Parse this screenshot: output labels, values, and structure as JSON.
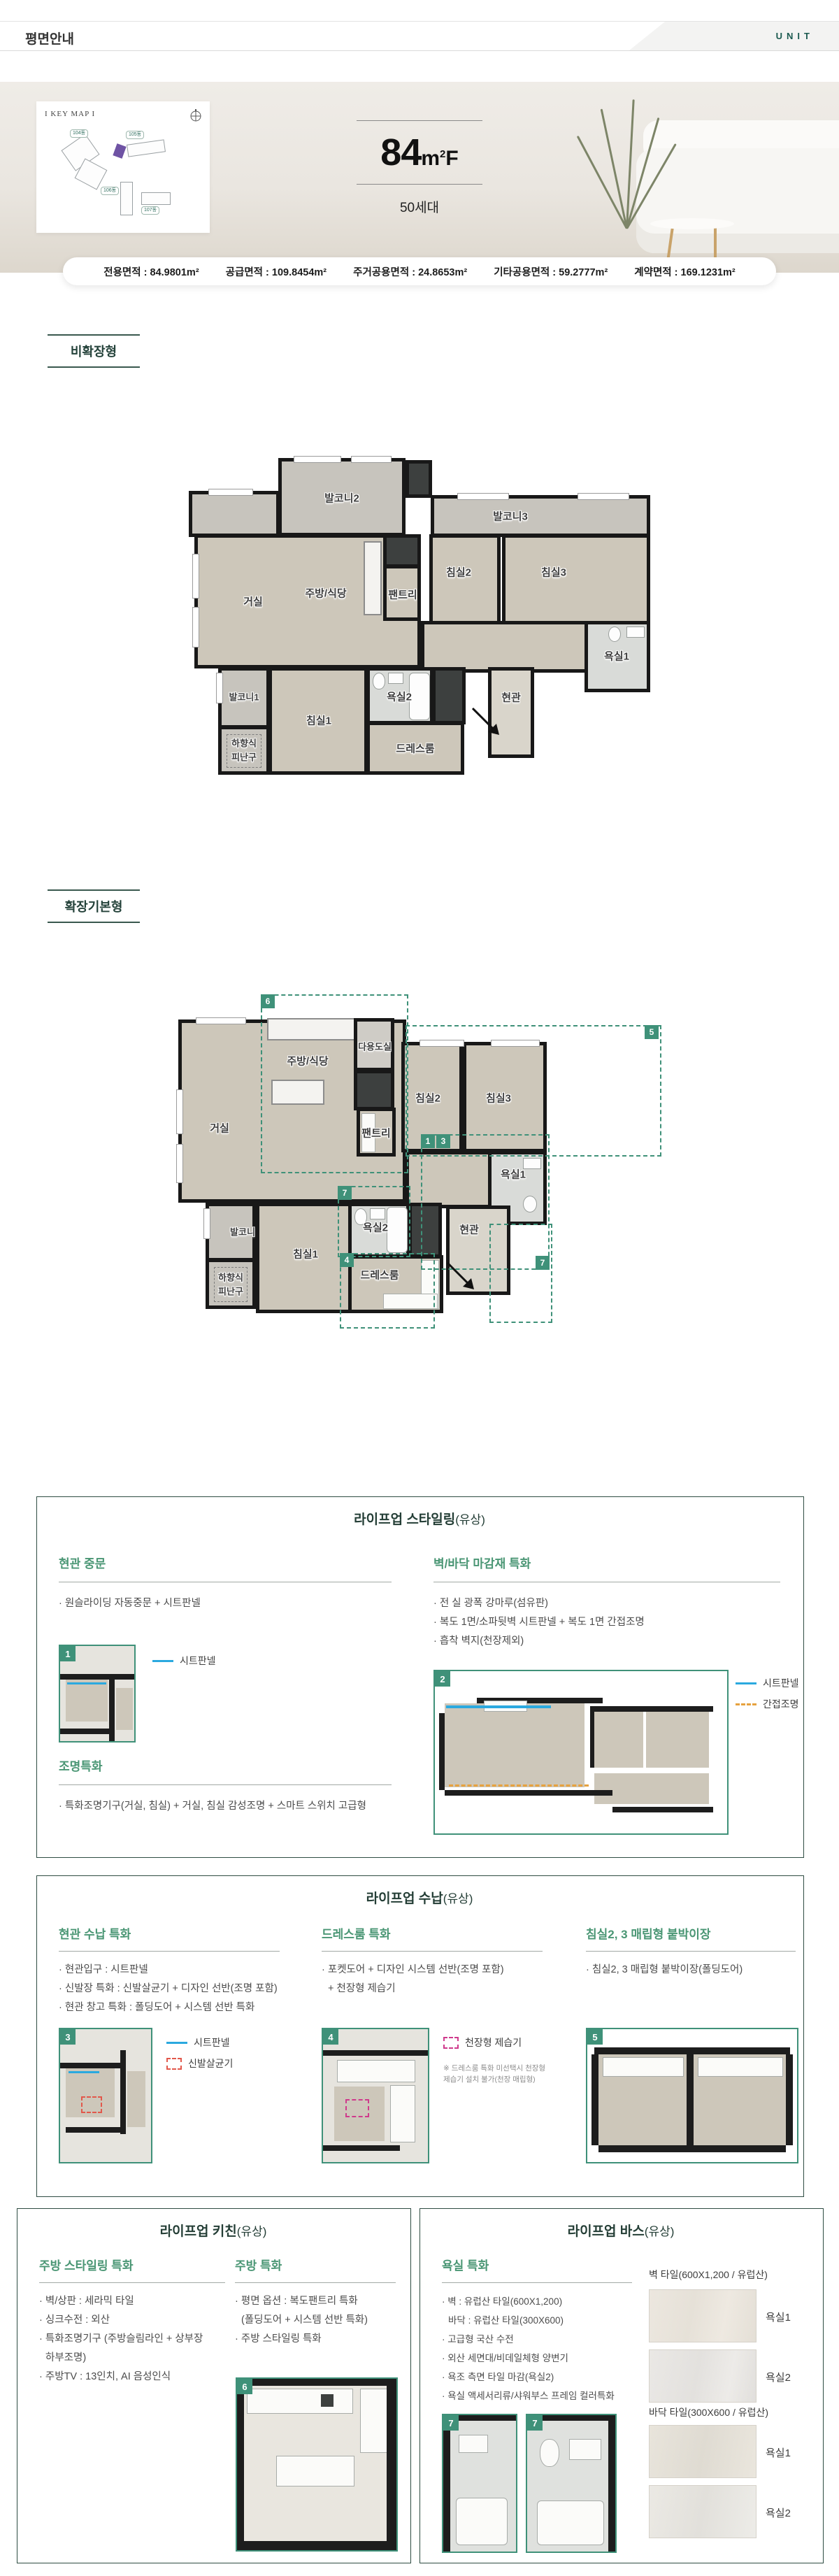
{
  "header": {
    "title": "평면안내",
    "brand": "UNIT"
  },
  "hero": {
    "keymap_label": "I KEY MAP I",
    "buildings": [
      "104동",
      "105동",
      "106동",
      "107동"
    ],
    "unit": {
      "number": "84",
      "suffix": "m",
      "sup": "2",
      "type": "F"
    },
    "households": "50세대"
  },
  "area_bar": {
    "colon": " : ",
    "items": [
      {
        "label": "전용면적",
        "value": "84.9801m²"
      },
      {
        "label": "공급면적",
        "value": "109.8454m²"
      },
      {
        "label": "주거공용면적",
        "value": "24.8653m²"
      },
      {
        "label": "기타공용면적",
        "value": "59.2777m²"
      },
      {
        "label": "계약면적",
        "value": "169.1231m²"
      }
    ]
  },
  "sections": {
    "plan1_label": "비확장형",
    "plan2_label": "확장기본형"
  },
  "plan1": {
    "rooms": {
      "balcony2": "발코니2",
      "balcony3": "발코니3",
      "living": "거실",
      "kitchen": "주방/식당",
      "pantry": "팬트리",
      "bed2": "침실2",
      "bed3": "침실3",
      "bath1": "욕실1",
      "balcony1": "발코니1",
      "escape_a": "하향식",
      "escape_b": "피난구",
      "bed1": "침실1",
      "bath2": "욕실2",
      "dress": "드레스룸",
      "entry": "현관"
    }
  },
  "plan2": {
    "rooms": {
      "kitchen": "주방/식당",
      "utility": "다용도실",
      "living": "거실",
      "pantry": "팬트리",
      "bed2": "침실2",
      "bed3": "침실3",
      "bath1": "욕실1",
      "entry": "현관",
      "balcony": "발코니",
      "escape_a": "하향식",
      "escape_b": "피난구",
      "bed1": "침실1",
      "bath2": "욕실2",
      "dress": "드레스룸"
    },
    "markers": {
      "m6": "6",
      "m5": "5",
      "m1": "1",
      "m3": "3",
      "m7": "7",
      "m4": "4",
      "m7b": "7"
    }
  },
  "legend": {
    "sheet": "시트판넬",
    "indirect": "간접조명",
    "sterilizer": "신발살균기",
    "dehumidifier": "천장형 제습기"
  },
  "styling_box": {
    "title": "라이프업 스타일링",
    "title_sub": "(유상)",
    "door_heading": "현관 중문",
    "door_b0": "· 원슬라이딩 자동중문 + 시트판넬",
    "door_thumb": "1",
    "finish_heading": "벽/바닥 마감재 특화",
    "finish_b0": "· 전 실 광폭 강마루(섬유판)",
    "finish_b1": "· 복도 1면/소파뒷벽 시트판넬 + 복도 1면 간접조명",
    "finish_b2": "· 흡착 벽지(천장제외)",
    "finish_thumb": "2",
    "light_heading": "조명특화",
    "light_b0": "· 특화조명기구(거실, 침실) + 거실, 침실 감성조명 + 스마트 스위치 고급형"
  },
  "storage_box": {
    "title": "라이프업 수납",
    "title_sub": "(유상)",
    "c1_heading": "현관 수납 특화",
    "c1_b0": "· 현관입구 : 시트판넬",
    "c1_b1": "· 신발장 특화 : 신발살균기 + 디자인 선반(조명 포함)",
    "c1_b2": "· 현관 창고 특화 : 폴딩도어 + 시스템 선반 특화",
    "c1_thumb": "3",
    "c2_heading": "드레스룸 특화",
    "c2_b0": "· 포켓도어 + 디자인 시스템 선반(조명 포함)",
    "c2_b1": "+ 천장형 제습기",
    "c2_thumb": "4",
    "c2_note0": "※ 드레스룸 특화 미선택시 천장형",
    "c2_note1": "제습기 설치 불가(천장 매립형)",
    "c3_heading": "침실2, 3 매립형 붙박이장",
    "c3_b0": "· 침실2, 3 매립형 붙박이장(폴딩도어)",
    "c3_thumb": "5"
  },
  "kitchen_box": {
    "title": "라이프업 키친",
    "title_sub": "(유상)",
    "c1_heading": "주방 스타일링 특화",
    "c1_b0": "· 벽/상판 : 세라믹 타일",
    "c1_b1": "· 싱크수전 : 외산",
    "c1_b2": "· 특화조명기구 (주방슬림라인 + 상부장",
    "c1_b3": "하부조명)",
    "c1_b4": "· 주방TV : 13인치, AI 음성인식",
    "c2_heading": "주방 특화",
    "c2_b0": "· 평면 옵션 : 복도팬트리 특화",
    "c2_b1": "(폴딩도어 + 시스템 선반 특화)",
    "c2_b2": "· 주방 스타일링 특화",
    "thumb": "6"
  },
  "bath_box": {
    "title": "라이프업 바스",
    "title_sub": "(유상)",
    "heading": "욕실 특화",
    "b0": "· 벽 : 유럽산 타일(600X1,200)",
    "b1": "바닥 : 유럽산 타일(300X600)",
    "b2": "· 고급형 국산 수전",
    "b3": "· 외산 세면대/비데일체형 양변기",
    "b4": "· 욕조 측면 타일 마감(욕실2)",
    "b5": "· 욕실 액세서리류/샤워부스 프레임 컬러특화",
    "thumb_a": "7",
    "thumb_b": "7",
    "tiles": {
      "wall_header": "벽 타일(600X1,200 / 유럽산)",
      "floor_header": "바닥 타일(300X600 / 유럽산)",
      "wall_l0": "욕실1",
      "wall_l1": "욕실2",
      "floor_l0": "욕실1",
      "floor_l1": "욕실2"
    }
  }
}
